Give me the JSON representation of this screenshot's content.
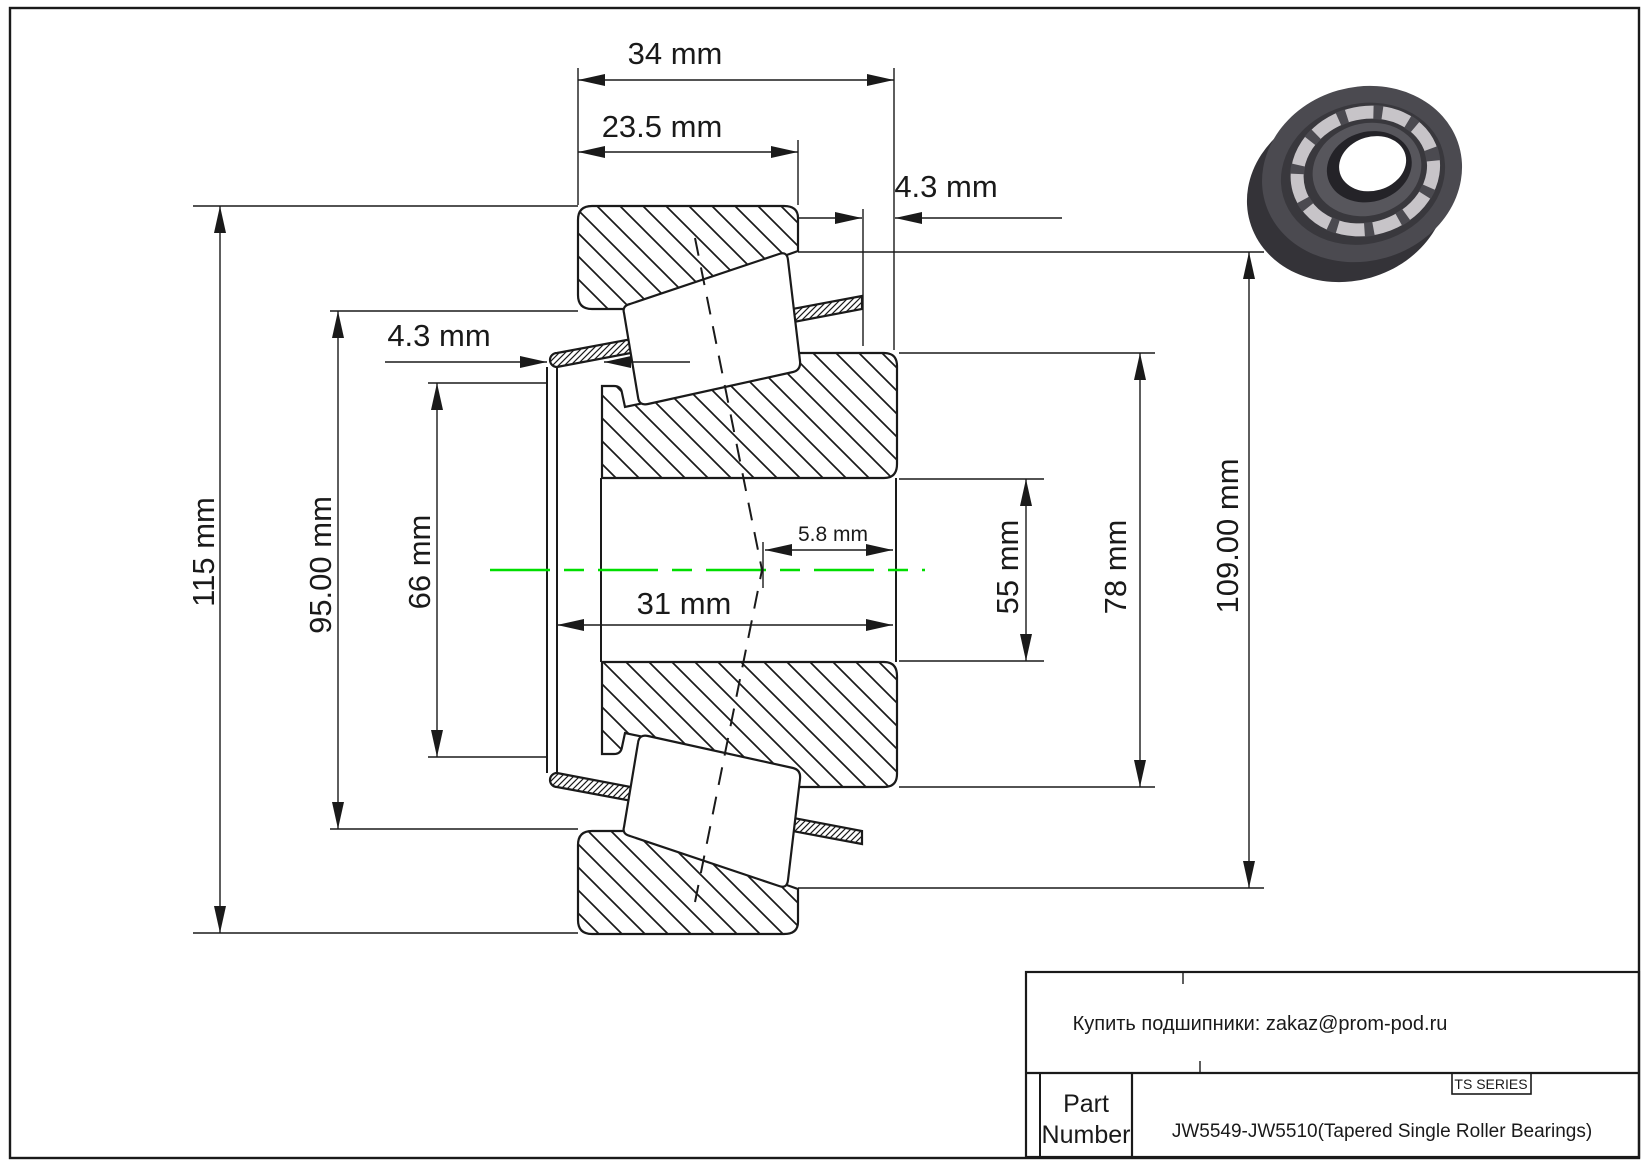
{
  "drawing": {
    "labels": {
      "d34": "34 mm",
      "d23_5": "23.5 mm",
      "d4_3_top": "4.3 mm",
      "d4_3_left": "4.3 mm",
      "d5_8": "5.8 mm",
      "d31": "31 mm",
      "d115": "115 mm",
      "d95": "95.00 mm",
      "d66": "66 mm",
      "d55": "55 mm",
      "d78": "78 mm",
      "d109": "109.00 mm"
    },
    "centerline_color": "#00DE00",
    "line_color": "#1a1a1a"
  },
  "title_block": {
    "contact": "Купить подшипники: zakaz@prom-pod.ru",
    "series": "TS SERIES",
    "part_label_lines": [
      "Part",
      "Number"
    ],
    "part_number": "JW5549-JW5510(Tapered Single Roller Bearings)"
  }
}
